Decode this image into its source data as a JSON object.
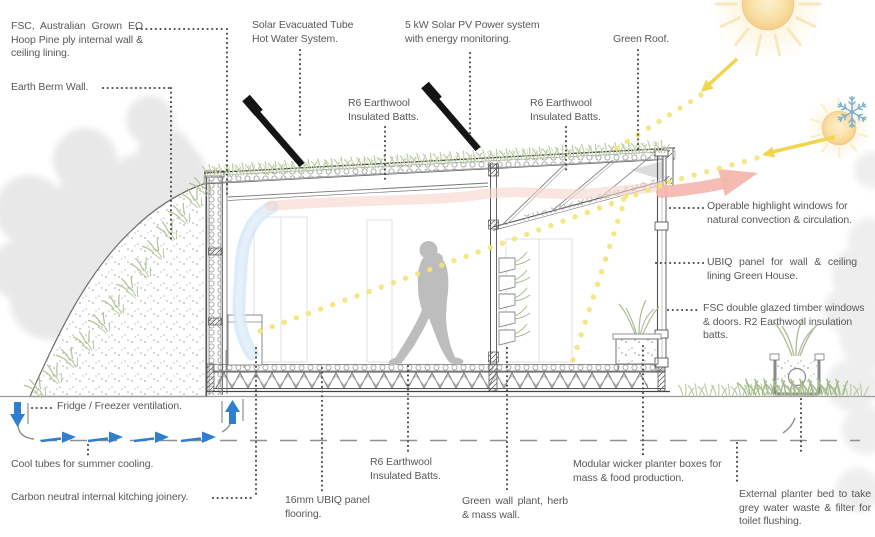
{
  "diagram": {
    "callouts": {
      "fsc_ply": "FSC, Australian Grown EO Hoop Pine ply internal wall & ceiling lining.",
      "earth_berm": "Earth Berm Wall.",
      "solar_hot_water": "Solar Evacuated Tube Hot Water System.",
      "r6_batts_roof_left": "R6 Earthwool Insulated Batts.",
      "solar_pv": "5 kW Solar PV Power system with energy monitoring.",
      "r6_batts_roof_right": "R6 Earthwool Insulated Batts.",
      "green_roof": "Green Roof.",
      "operable_windows": "Operable highlight windows for natural convection & circulation.",
      "ubiq_panel": "UBIQ panel for wall & ceiling lining Green House.",
      "fsc_glazing": "FSC double glazed timber windows & doors. R2 Earthwool insulation batts.",
      "fridge_vent": "Fridge / Freezer ventilation.",
      "cool_tubes": "Cool tubes for summer cooling.",
      "carbon_joinery": "Carbon neutral internal kitching joinery.",
      "ubiq_floor": "16mm UBIQ panel flooring.",
      "r6_batts_floor": "R6 Earthwool Insulated Batts.",
      "green_wall": "Green wall plant, herb & mass wall.",
      "wicker_planters": "Modular wicker planter boxes for mass & food production.",
      "external_planter": "External planter bed to take grey water waste & filter for toilet flushing."
    },
    "icons": [
      "summer-sun-icon",
      "winter-sun-icon",
      "snowflake-icon",
      "solar-hot-water-collector-icon",
      "solar-pv-panel-icon",
      "warm-air-arrow-icon",
      "cool-air-band-icon",
      "sun-ray-dotted-line",
      "cool-tube-arrow-icon",
      "fridge-vent-arrow-icon",
      "person-figure",
      "green-roof-grass",
      "earth-berm",
      "background-trees"
    ],
    "colors": {
      "label_text": "#57585a",
      "leader_dots": "#4a4a4a",
      "sun_ray_yellow": "#f2e678",
      "sun_arrow_yellow": "#f1d54e",
      "warm_air_pink": "#f4b6ad",
      "cool_air_blue": "#d3e7f6",
      "vent_arrow_blue": "#2e7fd0",
      "snowflake_blue": "#79aed3",
      "grass_green": "#b7c9a0",
      "structure_gray": "#555555",
      "tree_gray": "#e0e0e0"
    }
  }
}
